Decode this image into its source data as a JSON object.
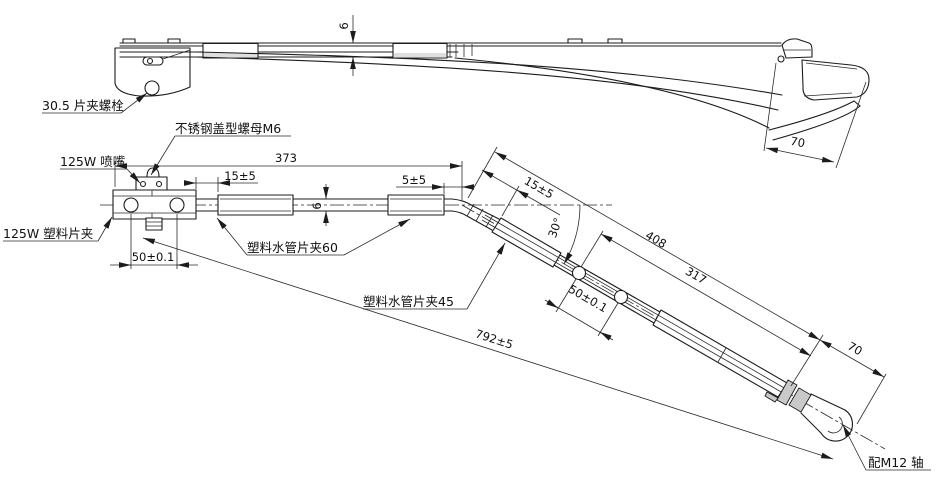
{
  "drawing": {
    "type": "engineering-drawing",
    "subject": "wiper-arm-two-views",
    "labels": {
      "clamp_bolt": "30.5 片夹螺栓",
      "cap_nut": "不锈钢盖型螺母M6",
      "nozzle": "125W 喷嘴",
      "plastic_clamp": "125W 塑料片夹",
      "pipe_clamp_60": "塑料水管片夹60",
      "pipe_clamp_45": "塑料水管片夹45",
      "shaft": "配M12 轴"
    },
    "dimensions": {
      "thickness_top": "6",
      "overall_straight": "373",
      "head_gap": "15±5",
      "clamp_gap": "5±5",
      "hole_spacing_head": "50±0.1",
      "thickness_bottom": "6",
      "bend_gap": "15±5",
      "bend_angle": "30°",
      "angled_outer": "408",
      "angled_inner": "317",
      "hole_spacing_angled": "50±0.1",
      "hook_width_top": "70",
      "tip_length": "70",
      "overall_length": "792±5"
    }
  }
}
